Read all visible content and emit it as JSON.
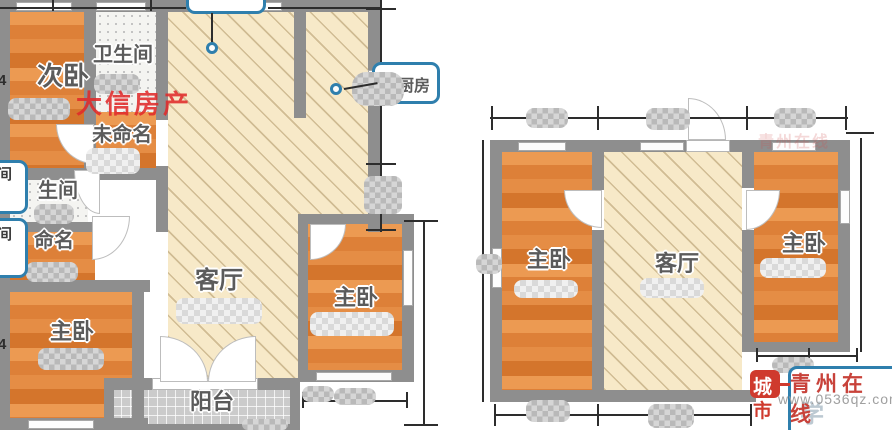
{
  "watermarks": {
    "agency": "大信房产",
    "site_name": "青州在线",
    "site_url": "www.0536qz.com",
    "seal_char_top": "城",
    "seal_char_bottom": "市",
    "faint_glyph": "学",
    "faint_tile": "青州在线"
  },
  "left_plan": {
    "rooms": {
      "secondary_bedroom": "次卧",
      "bathroom_top": "卫生间",
      "unnamed_top": "未命名",
      "bathroom_mid": "生间",
      "unnamed_mid": "命名",
      "master_bedroom_left": "主卧",
      "living_room": "客厅",
      "master_bedroom_right": "主卧",
      "balcony": "阳台"
    },
    "callouts": {
      "kitchen": "厨房",
      "edge_box_top": "卫生间",
      "edge_box_bottom": "衣帽间"
    },
    "dims": {
      "left_upper": "4",
      "left_lower": "4"
    }
  },
  "right_plan": {
    "rooms": {
      "master_bedroom_left": "主卧",
      "living_room": "客厅",
      "master_bedroom_right": "主卧"
    }
  }
}
